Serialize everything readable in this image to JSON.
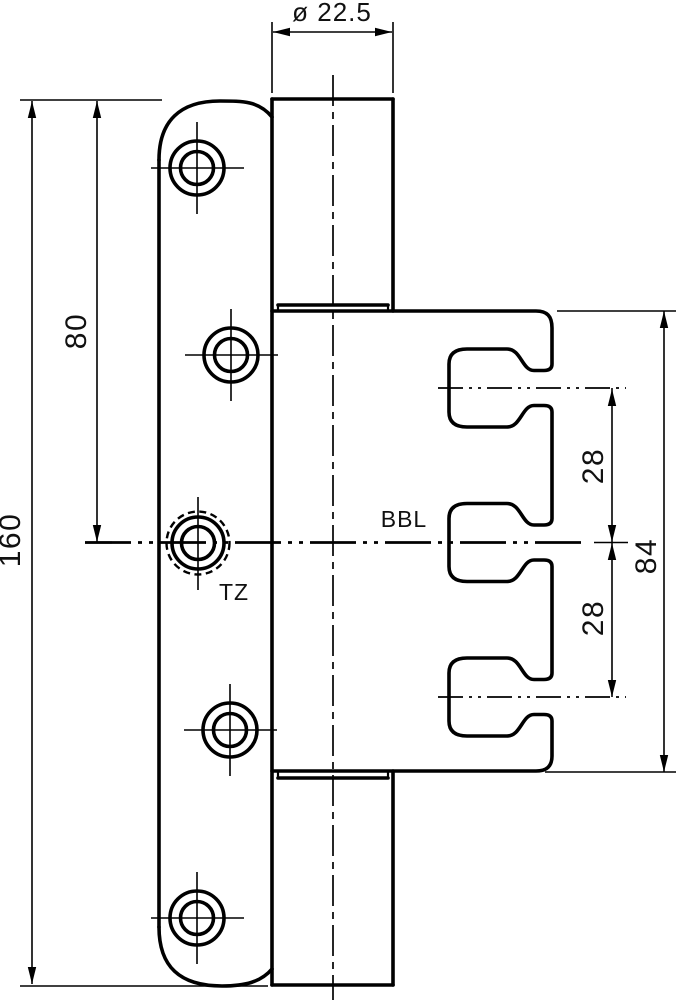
{
  "drawing": {
    "type": "technical-drawing",
    "subject": "door hinge front view with door leaf, knuckle and frame leaf",
    "colors": {
      "line": "#000000",
      "background": "#ffffff"
    },
    "dimensions": {
      "knuckle_diameter": "ø 22.5",
      "leaf_length": "160",
      "pivot_offset": "80",
      "slot_pitch_upper": "28",
      "slot_pitch_lower": "28",
      "frame_leaf_length": "84"
    },
    "labels": {
      "bbl": "BBL",
      "tz": "TZ"
    }
  }
}
